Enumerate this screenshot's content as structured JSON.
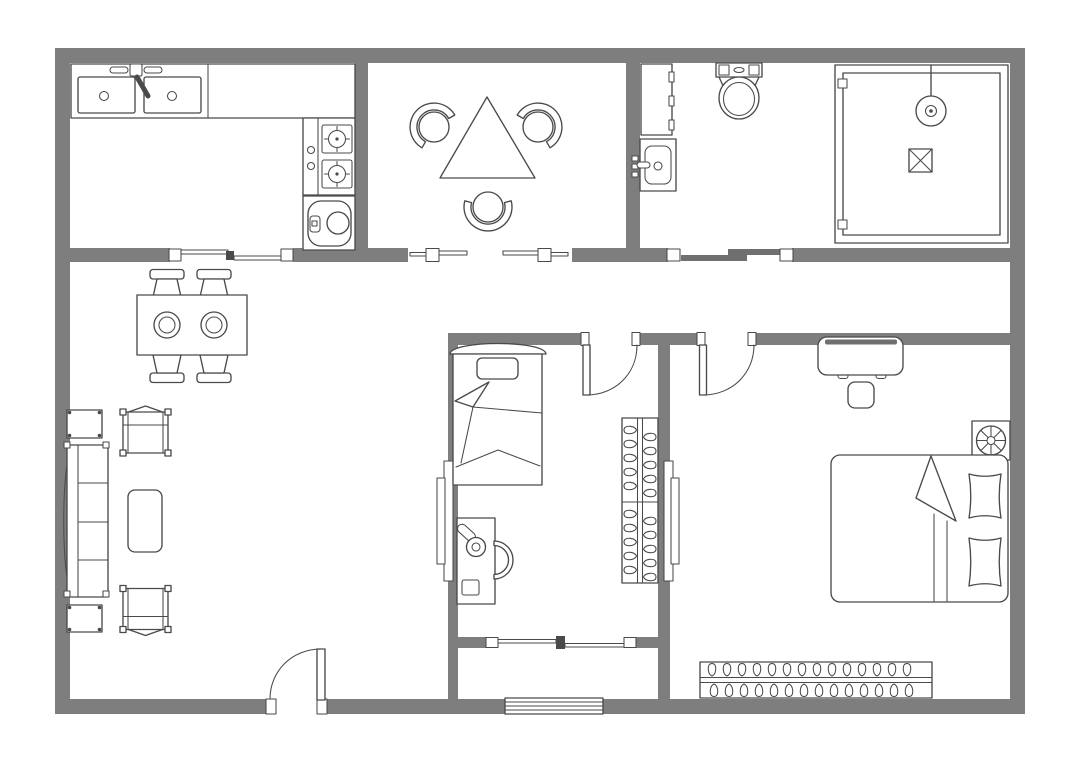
{
  "app": {
    "type": "floor-plan-diagram",
    "title": "House floor plan"
  },
  "palette": {
    "wall": "#7e7e7e",
    "line": "#4a4a4a",
    "slider": "#6f6f6f",
    "background": "#ffffff"
  },
  "rooms": [
    {
      "name": "kitchen",
      "furniture": [
        "kitchen-counter",
        "double-sink",
        "faucet",
        "two-burner-stove",
        "washing-machine"
      ]
    },
    {
      "name": "dining-room",
      "furniture": [
        "triangular-table",
        "tub-chair-left",
        "tub-chair-right",
        "tub-chair-bottom"
      ]
    },
    {
      "name": "bathroom",
      "furniture": [
        "storage-cabinet",
        "wash-basin",
        "toilet",
        "shower-enclosure",
        "shower-head",
        "floor-drain"
      ]
    },
    {
      "name": "living-area",
      "furniture": [
        "dining-table",
        "plate",
        "plate",
        "side-chair",
        "side-chair",
        "side-chair",
        "side-chair",
        "sofa",
        "side-table",
        "side-table",
        "armchair",
        "armchair",
        "coffee-table"
      ]
    },
    {
      "name": "bedroom-small",
      "furniture": [
        "single-bed",
        "pillow",
        "desk",
        "desk-lamp",
        "desk-chair",
        "wardrobe-with-hangers"
      ]
    },
    {
      "name": "bedroom-master",
      "furniture": [
        "double-bed",
        "pillow",
        "pillow",
        "dresser",
        "stool",
        "ceiling-fan",
        "wardrobe-with-hangers"
      ]
    },
    {
      "name": "balcony",
      "furniture": []
    }
  ],
  "openings": {
    "entrance_doors": 1,
    "hinged_doors": 2,
    "sliding_doors": 1,
    "sliding_windows": 3,
    "interior_windows": 2,
    "louver_windows": 1
  }
}
